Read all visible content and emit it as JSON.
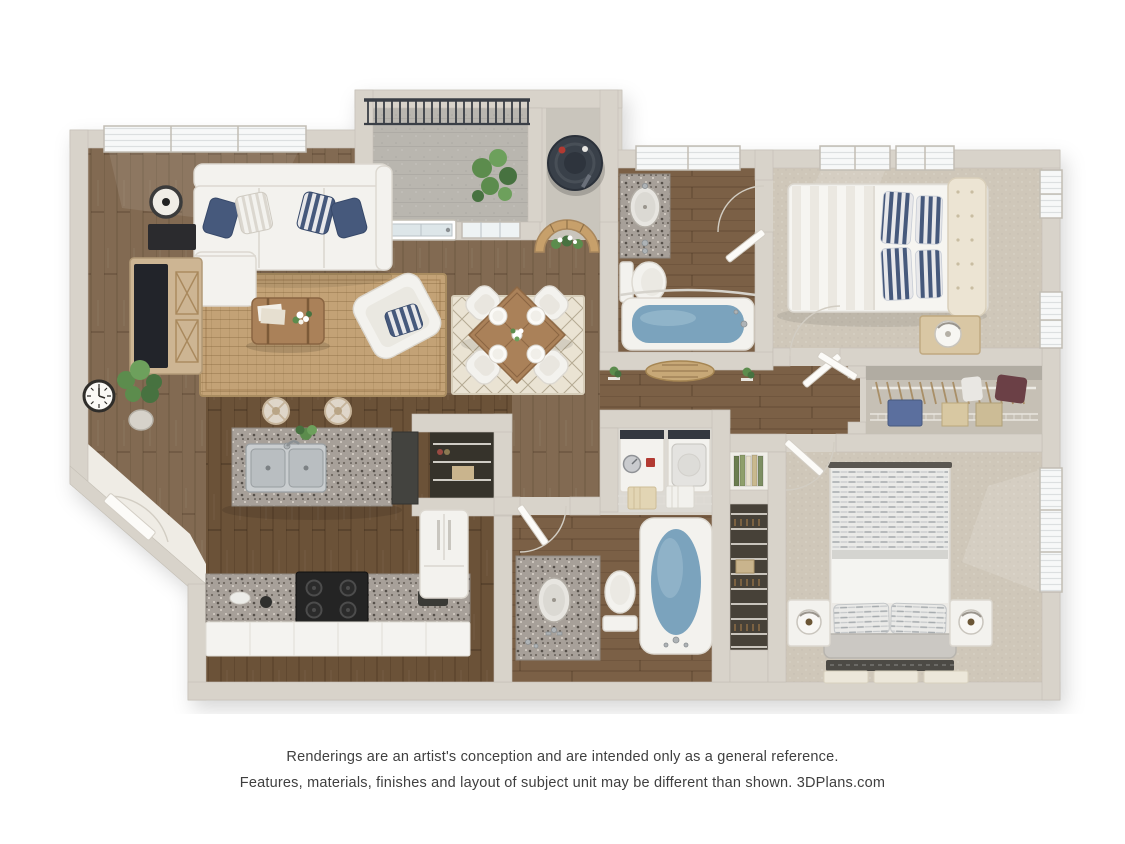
{
  "disclaimer": {
    "line1": "Renderings are an artist's conception and are intended only as a general reference.",
    "line2": "Features, materials, finishes and layout of subject unit may be different than shown. 3DPlans.com"
  },
  "palette": {
    "bg": "#ffffff",
    "text": "#3f3f3f",
    "wall": "#d8d3ca",
    "wall-line": "#c4bfb5",
    "wood-living": "#826a52",
    "wood-kitchen": "#6b5238",
    "wood-bath": "#7b6046",
    "carpet": "#cfc7b9",
    "concrete": "#b9b6af",
    "granite": "#a7a099",
    "rug-jute": "#c3a276",
    "rug-cream": "#eae3d3",
    "water": "#7ba3bd",
    "water-light": "#a3c2d3",
    "white-furn": "#f3f2ee",
    "furn-line": "#dcd8d0",
    "navy": "#46597c",
    "wood-furn": "#aa8159",
    "wood-light": "#d9c7a4",
    "railing": "#3a3f46",
    "appliance-dark": "#343840",
    "stove": "#242424",
    "green": "#5c8c4d",
    "tile": "#efece5",
    "linen-dark": "#474138"
  }
}
